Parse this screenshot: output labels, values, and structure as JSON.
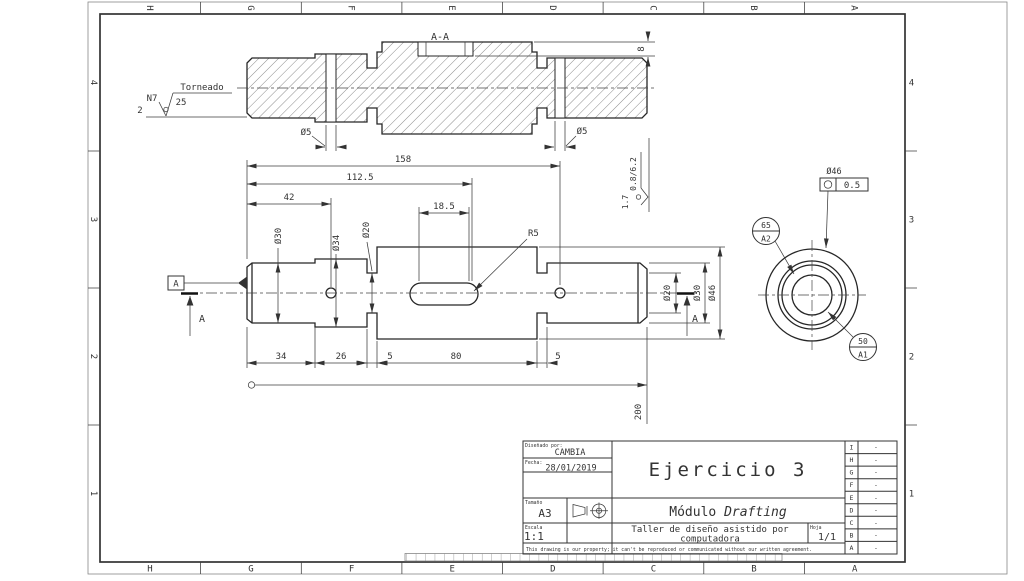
{
  "drawing": {
    "zone_columns": [
      "H",
      "G",
      "F",
      "E",
      "D",
      "C",
      "B",
      "A"
    ],
    "zone_rows": [
      "4",
      "3",
      "2",
      "1"
    ]
  },
  "surface_note": {
    "process": "Torneado",
    "roughness": "25",
    "grade": "N7",
    "count": "2"
  },
  "side_note": {
    "values": "0.8/6.2",
    "extra": "1.7"
  },
  "section_view": {
    "title": "A-A",
    "dim_hole_left": "Ø5",
    "dim_hole_right": "Ø5",
    "dim_key_depth": "8"
  },
  "front_view": {
    "dim_total_158": "158",
    "dim_1125": "112.5",
    "dim_42": "42",
    "dim_185": "18.5",
    "dim_34": "34",
    "dim_26": "26",
    "dim_5a": "5",
    "dim_80": "80",
    "dim_5b": "5",
    "dim_200": "200",
    "dia_30_left": "Ø30",
    "dia_34": "Ø34",
    "dia_20_left": "Ø20",
    "dia_20_right": "Ø20",
    "dia_30_right": "Ø30",
    "dia_46": "Ø46",
    "radius": "R5",
    "datum_label": "A",
    "cut_label_left": "A",
    "cut_label_right": "A"
  },
  "end_view": {
    "dia_label": "Ø46",
    "tolerance_value": "0.5",
    "target_a2_top": "65",
    "target_a2_bottom": "A2",
    "target_a1_top": "50",
    "target_a1_bottom": "A1"
  },
  "title_block": {
    "designed_by_label": "Diseñado por:",
    "designed_by": "CAMBIA",
    "date_label": "Fecha:",
    "date": "28/01/2019",
    "size_label": "Tamaño",
    "size": "A3",
    "scale_label": "Escala",
    "scale": "1:1",
    "title": "Ejercicio 3",
    "subtitle_prefix": "Módulo ",
    "subtitle_emph": "Drafting",
    "description_line1": "Taller de diseño asistido por",
    "description_line2": "computadora",
    "sheet_label": "Hoja",
    "sheet": "1/1",
    "revision_rows": [
      "I",
      "H",
      "G",
      "F",
      "E",
      "D",
      "C",
      "B",
      "A"
    ],
    "revision_value": "-",
    "disclaimer": "This drawing is our property; it can't be reproduced or communicated without our written agreement."
  }
}
